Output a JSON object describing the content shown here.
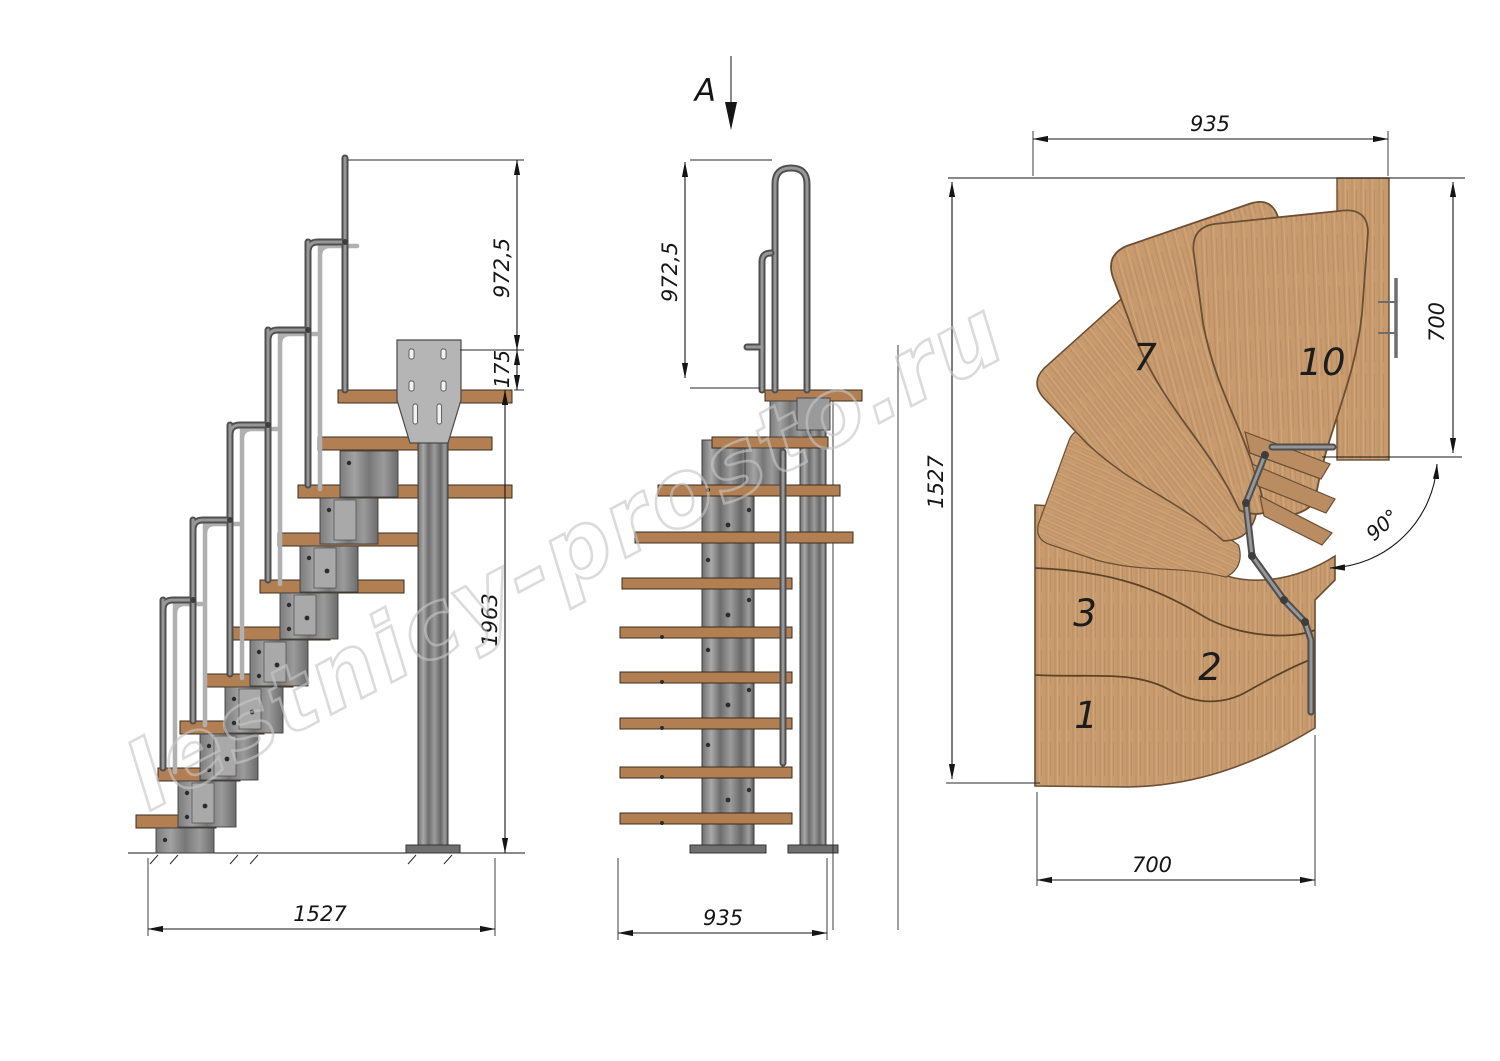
{
  "watermark": {
    "text": "lestnicy-prosto.ru"
  },
  "side_view": {
    "dim_handrail_height": "972,5",
    "dim_support_offset": "175",
    "dim_floor_to_landing": "1963",
    "dim_total_run": "1527"
  },
  "front_view": {
    "section_label": "A",
    "dim_handrail_height": "972,5",
    "dim_width": "935"
  },
  "plan_view": {
    "dim_top_width": "935",
    "dim_right_depth": "700",
    "dim_left_depth": "1527",
    "dim_bottom_width": "700",
    "dim_angle": "90°",
    "labels": {
      "t1": "1",
      "t2": "2",
      "t3": "3",
      "t7": "7",
      "t10": "10"
    }
  },
  "colors": {
    "wood": "#c79b6e",
    "wood_shadow": "#6b4e33",
    "tread_side": "#b27f52",
    "metal": "#8f8f8f",
    "metal_dark": "#4a4a4a",
    "plate": "#b5b5b5",
    "line": "#1c1c1c",
    "watermark": "#c6c6c6"
  }
}
